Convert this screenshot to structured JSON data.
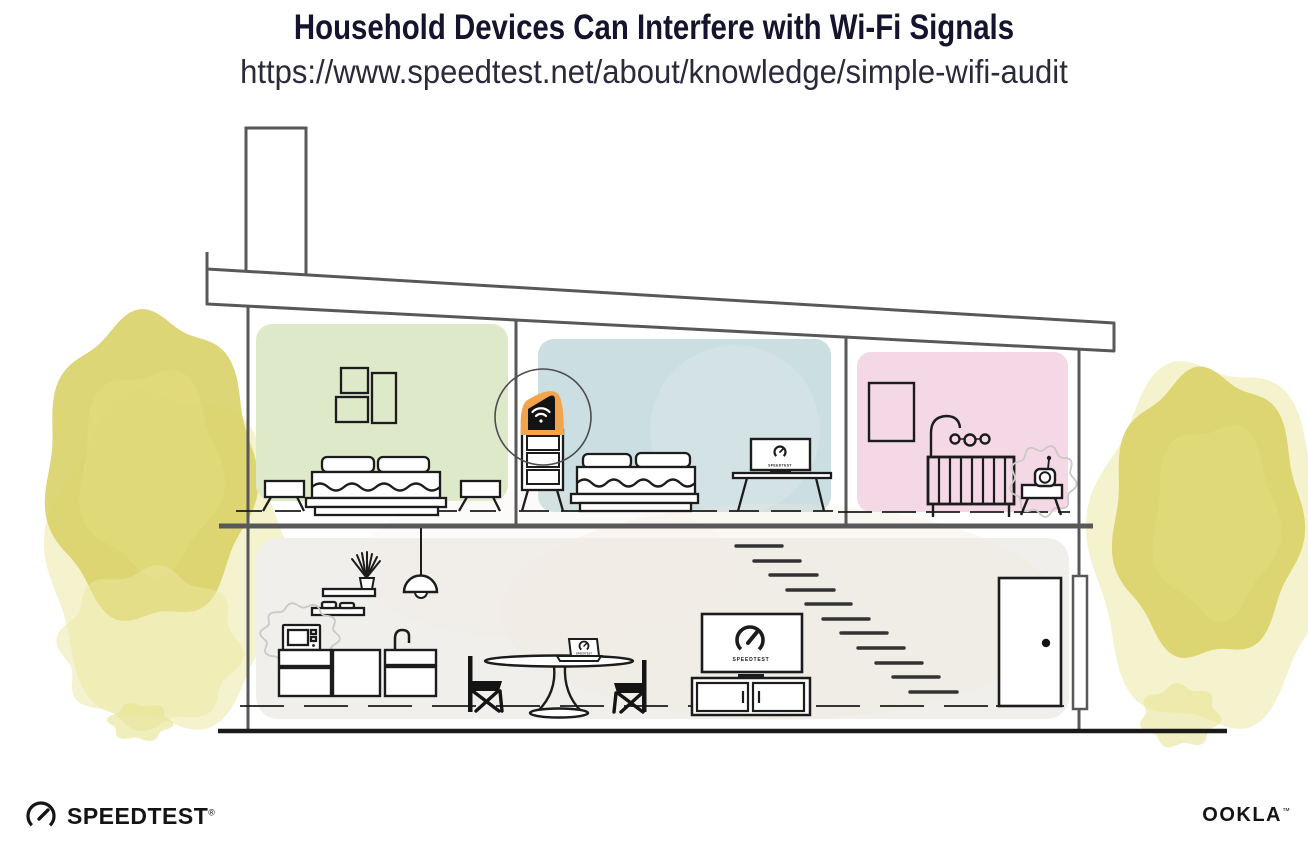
{
  "header": {
    "title": "Household Devices Can Interfere with Wi-Fi Signals",
    "url": "https://www.speedtest.net/about/knowledge/simple-wifi-audit"
  },
  "screens": {
    "tv_label": "SPEEDTEST",
    "desk_monitor_label": "SPEEDTEST",
    "laptop_label": "SPEEDTEST"
  },
  "branding": {
    "speedtest_wordmark": "SPEEDTEST",
    "speedtest_mark": "®",
    "ookla_wordmark": "OOKLA",
    "ookla_mark": "™"
  },
  "palette": {
    "title_text": "#15142e",
    "structure_line": "#58585a",
    "furniture_line": "#1b1b1b",
    "bedroom_green_wall": "#dee9ca",
    "bedroom_blue_wall": "#cbdee1",
    "nursery_pink_wall": "#f4d8e6",
    "ground_floor_grey": "#f0efec",
    "foliage_yellow": "#d9d267",
    "router_orange": "#f2a44c"
  },
  "icons": {
    "router": "wifi-icon",
    "speedtest_logo": "gauge-icon",
    "interference": "burst-outline-icon"
  }
}
